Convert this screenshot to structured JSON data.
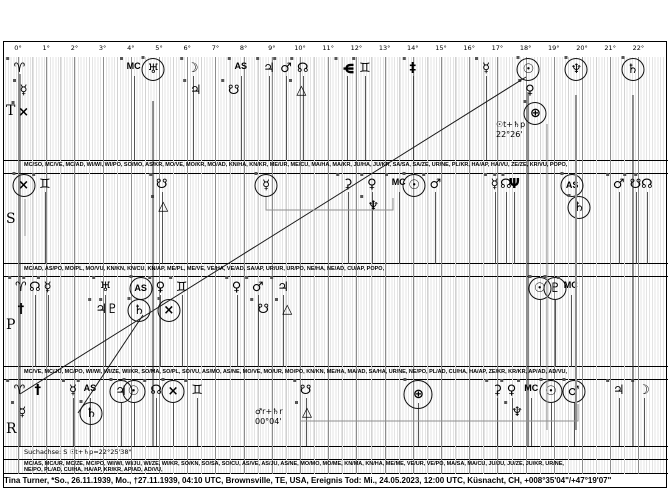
{
  "chart_data": {
    "type": "scatter",
    "variant": "uranian-astrology-graphical-22deg-sort",
    "x_ticks": [
      "0°",
      "1°",
      "2°",
      "3°",
      "4°",
      "5°",
      "6°",
      "7°",
      "8°",
      "9°",
      "10°",
      "11°",
      "12°",
      "13°",
      "14°",
      "15°",
      "16°",
      "17°",
      "18°",
      "19°",
      "20°",
      "21°",
      "22°"
    ],
    "x_axis": {
      "unit": "degrees",
      "min": 0,
      "max": 22
    },
    "row_labels": [
      "T",
      "S",
      "P",
      "R"
    ],
    "rows": {
      "T": [
        {
          "d": 0.05,
          "g": "♈",
          "n": "aries-point",
          "ns": true
        },
        {
          "d": 0.2,
          "g": "☿",
          "n": "mercury",
          "l": 1
        },
        {
          "d": 0.2,
          "g": "×",
          "n": "vulkanus",
          "l": 2
        },
        {
          "d": 4.1,
          "g": "MC",
          "n": "mc",
          "t": true
        },
        {
          "d": 4.8,
          "g": "♅",
          "n": "uranus",
          "c": true,
          "ns": true
        },
        {
          "d": 6.2,
          "g": "☽",
          "n": "moon"
        },
        {
          "d": 6.3,
          "g": "♃",
          "n": "jupiter",
          "l": 1
        },
        {
          "d": 7.9,
          "g": "AS",
          "n": "ascendant",
          "t": true
        },
        {
          "d": 7.65,
          "g": "☋",
          "n": "hades",
          "l": 1
        },
        {
          "d": 8.9,
          "g": "♃",
          "n": "jupiter"
        },
        {
          "d": 9.5,
          "g": "♂",
          "n": "mars"
        },
        {
          "d": 10.1,
          "g": "☊",
          "n": "north-node"
        },
        {
          "d": 10.05,
          "g": "△",
          "n": "apollon",
          "l": 1
        },
        {
          "d": 11.65,
          "g": "Ψ",
          "n": "poseidon",
          "rot": 90
        },
        {
          "d": 12.3,
          "g": "♊",
          "n": "admetos"
        },
        {
          "d": 14.0,
          "g": "‡",
          "n": "kronos"
        },
        {
          "d": 16.6,
          "g": "☿",
          "n": "mercury"
        },
        {
          "d": 18.1,
          "g": "☉",
          "n": "sun",
          "c": true,
          "ns": true
        },
        {
          "d": 18.15,
          "g": "♀",
          "n": "venus",
          "l": 1
        },
        {
          "d": 18.35,
          "g": "⊕",
          "n": "earth-point",
          "l": 2,
          "c": true
        },
        {
          "d": 19.8,
          "g": "♆",
          "n": "neptune",
          "c": true,
          "ns": true
        },
        {
          "d": 21.8,
          "g": "♄",
          "n": "saturn",
          "c": true,
          "ns": true
        }
      ],
      "S": [
        {
          "d": 0.2,
          "g": "×",
          "n": "vulkanus",
          "c": true,
          "ns": true
        },
        {
          "d": 0.95,
          "g": "♊",
          "n": "admetos"
        },
        {
          "d": 5.1,
          "g": "☋",
          "n": "hades"
        },
        {
          "d": 5.15,
          "g": "△",
          "n": "apollon",
          "l": 1
        },
        {
          "d": 8.8,
          "g": "☿",
          "n": "mercury",
          "c": true,
          "ns": true
        },
        {
          "d": 11.7,
          "g": "⚳",
          "n": "ceres"
        },
        {
          "d": 12.55,
          "g": "♀",
          "n": "venus"
        },
        {
          "d": 12.6,
          "g": "♆",
          "n": "neptune",
          "l": 1
        },
        {
          "d": 13.5,
          "g": "MC",
          "n": "mc",
          "t": true
        },
        {
          "d": 14.05,
          "g": "☉",
          "n": "sun",
          "c": true,
          "ns": true
        },
        {
          "d": 14.8,
          "g": "♂",
          "n": "mars"
        },
        {
          "d": 16.9,
          "g": "☿",
          "n": "mercury"
        },
        {
          "d": 17.3,
          "g": "☊",
          "n": "north-node"
        },
        {
          "d": 17.6,
          "g": "Ψ",
          "n": "poseidon"
        },
        {
          "d": 19.65,
          "g": "AS",
          "n": "ascendant",
          "t": true,
          "c": true,
          "ns": true
        },
        {
          "d": 19.9,
          "g": "♄",
          "n": "saturn",
          "l": 1,
          "c": true
        },
        {
          "d": 21.3,
          "g": "♂",
          "n": "mars"
        },
        {
          "d": 21.9,
          "g": "☋",
          "n": "hades"
        },
        {
          "d": 22.3,
          "g": "☊",
          "n": "north-node"
        }
      ],
      "P": [
        {
          "d": 0.1,
          "g": "♈",
          "n": "aries-point",
          "ns": true
        },
        {
          "d": 0.1,
          "g": "†",
          "n": "cross-point",
          "l": 1
        },
        {
          "d": 0.6,
          "g": "☊",
          "n": "north-node"
        },
        {
          "d": 1.05,
          "g": "☿",
          "n": "mercury"
        },
        {
          "d": 3.1,
          "g": "♅",
          "n": "uranus"
        },
        {
          "d": 2.95,
          "g": "♃",
          "n": "jupiter",
          "l": 1
        },
        {
          "d": 3.35,
          "g": "♇",
          "n": "pluto",
          "l": 1
        },
        {
          "d": 4.35,
          "g": "AS",
          "n": "ascendant",
          "t": true,
          "c": true,
          "ns": true
        },
        {
          "d": 4.3,
          "g": "♄",
          "n": "saturn",
          "l": 1,
          "c": true
        },
        {
          "d": 5.05,
          "g": "♀",
          "n": "venus"
        },
        {
          "d": 5.35,
          "g": "×",
          "n": "vulkanus",
          "l": 1,
          "c": true
        },
        {
          "d": 5.8,
          "g": "♊",
          "n": "admetos"
        },
        {
          "d": 7.75,
          "g": "♀",
          "n": "venus"
        },
        {
          "d": 8.5,
          "g": "♂",
          "n": "mars"
        },
        {
          "d": 8.7,
          "g": "☋",
          "n": "hades",
          "l": 1
        },
        {
          "d": 9.4,
          "g": "♃",
          "n": "jupiter"
        },
        {
          "d": 9.55,
          "g": "△",
          "n": "apollon",
          "l": 1
        },
        {
          "d": 18.5,
          "g": "☉",
          "n": "sun",
          "c": true
        },
        {
          "d": 19.05,
          "g": "♇",
          "n": "pluto",
          "c": true
        },
        {
          "d": 19.6,
          "g": "MC",
          "n": "mc",
          "t": true
        }
      ],
      "R": [
        {
          "d": 0.05,
          "g": "♈",
          "n": "aries-point",
          "ns": true
        },
        {
          "d": 0.15,
          "g": "☿",
          "n": "mercury",
          "l": 1
        },
        {
          "d": 0.7,
          "g": "†",
          "n": "cross-point"
        },
        {
          "d": 1.95,
          "g": "☿",
          "n": "mercury"
        },
        {
          "d": 2.55,
          "g": "AS",
          "n": "ascendant",
          "t": true
        },
        {
          "d": 2.6,
          "g": "♄",
          "n": "saturn",
          "l": 1,
          "c": true
        },
        {
          "d": 3.65,
          "g": "♃",
          "n": "jupiter",
          "c": true
        },
        {
          "d": 4.1,
          "g": "☉",
          "n": "sun",
          "c": true
        },
        {
          "d": 4.9,
          "g": "☊",
          "n": "north-node"
        },
        {
          "d": 5.5,
          "g": "×",
          "n": "vulkanus",
          "c": true
        },
        {
          "d": 6.35,
          "g": "♊",
          "n": "admetos"
        },
        {
          "d": 10.2,
          "g": "☋",
          "n": "hades"
        },
        {
          "d": 10.25,
          "g": "△",
          "n": "apollon",
          "l": 1
        },
        {
          "d": 14.2,
          "g": "⊕",
          "n": "earth-point",
          "c": true,
          "r": 27
        },
        {
          "d": 17.0,
          "g": "⚳",
          "n": "ceres"
        },
        {
          "d": 17.5,
          "g": "♀",
          "n": "venus"
        },
        {
          "d": 17.7,
          "g": "♆",
          "n": "neptune",
          "l": 1
        },
        {
          "d": 18.2,
          "g": "MC",
          "n": "mc",
          "t": true
        },
        {
          "d": 18.9,
          "g": "☉",
          "n": "sun",
          "c": true
        },
        {
          "d": 19.7,
          "g": "♂",
          "n": "mars",
          "c": true
        },
        {
          "d": 21.3,
          "g": "♃",
          "n": "jupiter"
        },
        {
          "d": 22.2,
          "g": "☽",
          "n": "moon"
        }
      ]
    },
    "aspect_lines": [
      {
        "x1": 20,
        "y1": 394,
        "x2": 526,
        "y2": 77
      },
      {
        "x1": 143,
        "y1": 315,
        "x2": 78,
        "y2": 413
      }
    ],
    "axis_verticals": [
      {
        "x": 20,
        "y1": 74,
        "y2": 446
      },
      {
        "x": 153,
        "y1": 101,
        "y2": 446
      },
      {
        "x": 528,
        "y1": 92,
        "y2": 446
      },
      {
        "x": 547,
        "y1": 124,
        "y2": 430,
        "gray": true
      },
      {
        "x": 576,
        "y1": 95,
        "y2": 430,
        "gray": true,
        "w": 2
      },
      {
        "x": 633,
        "y1": 95,
        "y2": 446
      }
    ],
    "connectors": [
      [
        [
          25,
          199
        ],
        [
          25,
          236
        ]
      ],
      [
        [
          266,
          197
        ],
        [
          266,
          210
        ],
        [
          393,
          210
        ],
        [
          393,
          198
        ]
      ],
      [
        [
          300,
          421
        ],
        [
          578,
          421
        ],
        [
          578,
          404
        ]
      ]
    ],
    "annotations": [
      {
        "x": 496,
        "y": 120,
        "l1": "☉t+♄p",
        "l2": "22°26'"
      },
      {
        "x": 255,
        "y": 407,
        "l1": "♂r+♄r",
        "l2": "00°04'"
      }
    ]
  },
  "midpoint_rows": {
    "s": "MC/SO, MC/VE, MC/AD, WI/WI, WI/PO, SO/MO, AS/KR, MO/VE, MO/KR, MO/AD, KN/HA, KN/KR, ME/UR, ME/CU, MA/HA, MA/KR, JU/HA, JU/KR, SA/SA, SA/ZE, UR/NE, PL/KR, HA/AP, HA/VU, ZE/ZE, KR/VU, POPO,",
    "p": "MC/AD, AS/PO, MO/PL, MO/VU, KN/KN, KN/CU, KN/AP, ME/PL, ME/VE, VE/HA, VE/AD, SA/AP, UR/UR, UR/PO, NE/HA, NE/AD, CU/AP, POPO,",
    "r": "MC/VE, MC/JU, MC/PO, WI/WI, WI/ZE, WI/KR, SO/MA, SO/PL, SO/VU, AS/MO, AS/NE, MO/VE, MO/UR, MO/PO, KN/KN, ME/HA, MA/AD, SA/HA, UR/NE, NE/PO, PL/AD, CU/HA, HA/AP, ZE/KR, KR/KR, AP/AD, AD/VU,"
  },
  "footer": {
    "search_axis": "Suchachse: S ☉t+♄p=22°25'38\"",
    "midpoints_a": "MC/AS, MC/UR, MC/ZE, MC/PO, WI/WI, WI/JU, WI/ZE, WI/KR, SO/KN, SO/SA, SO/CU, AS/VE, AS/JU, AS/NE, MO/MO, MO/ME, KN/MA, KN/HA, ME/ME, VE/UR, VE/PO, MA/SA, MA/CU, JU/JU, JU/ZE, JU/KR, UR/NE,",
    "midpoints_b": "NE/PO, PL/AD, CU/HA, HA/AP, KR/KR, AP/AD, AD/VU,",
    "caption": "Tina Turner, *So., 26.11.1939, Mo., †27.11.1939, 04:10 UTC, Brownsville, TE, USA, Ereignis Tod: Mi., 24.05.2023, 12:00 UTC, Küsnacht, CH, +008°35'04\"/+47°19'07\""
  }
}
